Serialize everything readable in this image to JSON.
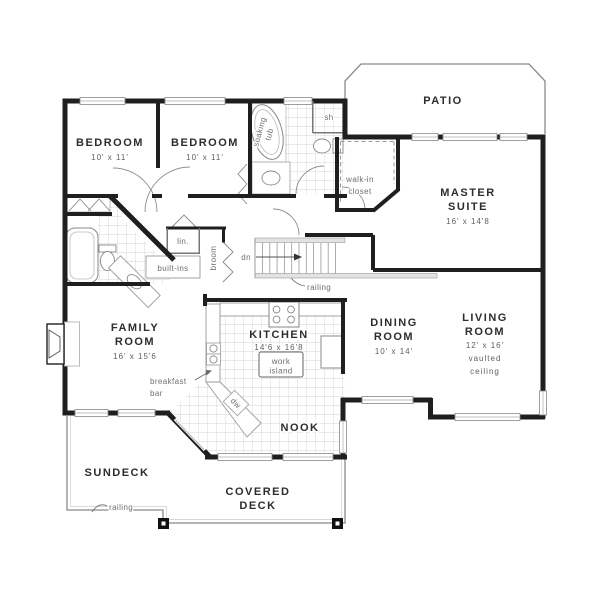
{
  "title": "two-storey house floor plan",
  "colors": {
    "background": "#ffffff",
    "wall": "#1f1f1f",
    "thin_line": "#8a8a8a",
    "tile_grid": "#c9c9c9",
    "room_text": "#2d2d2d",
    "dim_text": "#5e5e5e",
    "small_text": "#6e6e6e"
  },
  "rooms": {
    "bedroom1": {
      "name": "BEDROOM",
      "size": "10' x 11'"
    },
    "bedroom2": {
      "name": "BEDROOM",
      "size": "10' x 11'"
    },
    "master_suite": {
      "line1": "MASTER",
      "line2": "SUITE",
      "size": "16' x 14'8"
    },
    "family_room": {
      "line1": "FAMILY",
      "line2": "ROOM",
      "size": "16' x 15'6"
    },
    "kitchen": {
      "name": "KITCHEN",
      "size": "14'6 x 16'8"
    },
    "dining_room": {
      "line1": "DINING",
      "line2": "ROOM",
      "size": "10' x 14'"
    },
    "living_room": {
      "line1": "LIVING",
      "line2": "ROOM",
      "size": "12' x 16'",
      "note_line1": "vaulted",
      "note_line2": "ceiling"
    },
    "nook": {
      "name": "NOOK"
    },
    "patio": {
      "name": "PATIO"
    },
    "sundeck": {
      "name": "SUNDECK"
    },
    "covered_deck": {
      "line1": "COVERED",
      "line2": "DECK"
    }
  },
  "fixtures": {
    "soaking_tub_line1": "soaking",
    "soaking_tub_line2": "tub",
    "shower": "sh",
    "walk_in_closet_line1": "walk-in",
    "walk_in_closet_line2": "closet",
    "linen": "lin.",
    "broom": "broom",
    "built_ins": "built-ins",
    "work_island_line1": "work",
    "work_island_line2": "island",
    "dishwasher": "dw",
    "breakfast_bar_line1": "breakfast",
    "breakfast_bar_line2": "bar"
  },
  "annotations": {
    "down": "dn",
    "stair_railing": "railing",
    "deck_railing": "railing"
  }
}
